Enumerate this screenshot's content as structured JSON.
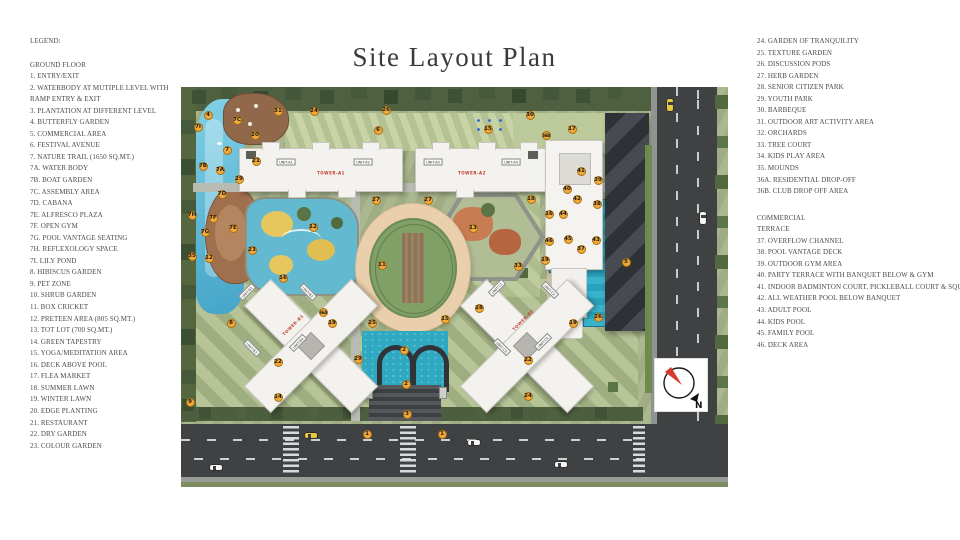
{
  "title": "Site Layout Plan",
  "legend_left": {
    "heading": "LEGEND:",
    "section": "GROUND FLOOR",
    "lines": [
      "1. ENTRY/EXIT",
      "2. WATERBODY AT MUTIPLE LEVEL WITH",
      "RAMP ENTRY & EXIT",
      "3. PLANTATION AT DIFFERENT LEVEL",
      "4. BUTTERFLY GARDEN",
      "5. COMMERCIAL AREA",
      "6. FESTIVAL AVENUE",
      "7. NATURE TRAIL (1650 SQ.MT.)",
      "7A. WATER BODY",
      "7B. BOAT GARDEN",
      "7C. ASSEMBLY AREA",
      "7D. CABANA",
      "7E. ALFRESCO PLAZA",
      "7F. OPEN GYM",
      "7G. POOL VANTAGE SEATING",
      "7H. REFLEXOLOGY SPACE",
      "7I. LILY POND",
      "8. HIBISCUS GARDEN",
      "9. PET ZONE",
      "10. SHRUB GARDEN",
      "11. BOX CRICKET",
      "12. PRETEEN AREA (805 SQ.MT.)",
      "13. TOT LOT (700 SQ.MT.)",
      "14. GREEN TAPESTRY",
      "15. YOGA/MEDITATION AREA",
      "16. DECK ABOVE POOL",
      "17. FLEA MARKET",
      "18. SUMMER LAWN",
      "19. WINTER LAWN",
      "20. EDGE PLANTING",
      "21. RESTAURANT",
      "22. DRY GARDEN",
      "23. COLOUR GARDEN"
    ]
  },
  "legend_right": {
    "lines_top": [
      "24. GARDEN OF TRANQUILITY",
      "25. TEXTURE GARDEN",
      "26. DISCUSSION PODS",
      "27. HERB GARDEN",
      "28. SENIOR CITIZEN PARK",
      "29. YOUTH PARK",
      "30. BARBEQUE",
      "31. OUTDOOR ART ACTIVITY AREA",
      "32. ORCHARDS",
      "33. TREE COURT",
      "34. KIDS PLAY AREA",
      "35. MOUNDS",
      "36A. RESIDENTIAL DROP-OFF",
      "36B. CLUB DROP OFF AREA"
    ],
    "section_lines": [
      "COMMERCIAL",
      "TERRACE"
    ],
    "lines_bottom": [
      "37. OVERFLOW CHANNEL",
      "38. POOL VANTAGE DECK",
      "39. OUTDOOR GYM AREA",
      "40. PARTY TERRACE WITH BANQUET BELOW & GYM",
      "41. INDOOR BADMINTON COURT, PICKLEBALL COURT & SQUASH COURT",
      "42. ALL WEATHER POOL BELOW BANQUET",
      "43. ADULT POOL",
      "44. KIDS POOL",
      "45. FAMILY POOL",
      "46. DECK AREA"
    ]
  },
  "plan": {
    "north_label": "N",
    "colors": {
      "lawn": "#a6b389",
      "marker": "#f2a93b",
      "water": "#46a5c8",
      "pool": "#2aa2bd",
      "road": "#3f4143",
      "north_red": "#d63a2f"
    },
    "markers": [
      {
        "n": "4",
        "x": 27,
        "y": 28
      },
      {
        "n": "7I",
        "x": 17,
        "y": 40
      },
      {
        "n": "7C",
        "x": 56,
        "y": 33
      },
      {
        "n": "20",
        "x": 74,
        "y": 48
      },
      {
        "n": "31",
        "x": 97,
        "y": 24
      },
      {
        "n": "24",
        "x": 133,
        "y": 24
      },
      {
        "n": "26",
        "x": 205,
        "y": 23
      },
      {
        "n": "30",
        "x": 349,
        "y": 28
      },
      {
        "n": "6",
        "x": 197,
        "y": 43
      },
      {
        "n": "15",
        "x": 307,
        "y": 42
      },
      {
        "n": "36B",
        "x": 365,
        "y": 48
      },
      {
        "n": "17",
        "x": 391,
        "y": 42
      },
      {
        "n": "7",
        "x": 46,
        "y": 63
      },
      {
        "n": "21",
        "x": 75,
        "y": 74
      },
      {
        "n": "7B",
        "x": 22,
        "y": 79
      },
      {
        "n": "7A",
        "x": 39,
        "y": 83
      },
      {
        "n": "29",
        "x": 58,
        "y": 92
      },
      {
        "n": "7D",
        "x": 41,
        "y": 107
      },
      {
        "n": "7H",
        "x": 11,
        "y": 128
      },
      {
        "n": "7F",
        "x": 32,
        "y": 131
      },
      {
        "n": "7E",
        "x": 52,
        "y": 141
      },
      {
        "n": "7G",
        "x": 24,
        "y": 145
      },
      {
        "n": "41",
        "x": 400,
        "y": 84
      },
      {
        "n": "39",
        "x": 417,
        "y": 93
      },
      {
        "n": "40",
        "x": 386,
        "y": 102
      },
      {
        "n": "42",
        "x": 396,
        "y": 112
      },
      {
        "n": "38",
        "x": 416,
        "y": 117
      },
      {
        "n": "18",
        "x": 350,
        "y": 112
      },
      {
        "n": "27",
        "x": 195,
        "y": 113
      },
      {
        "n": "27",
        "x": 247,
        "y": 113
      },
      {
        "n": "13",
        "x": 292,
        "y": 141
      },
      {
        "n": "12",
        "x": 132,
        "y": 140
      },
      {
        "n": "16",
        "x": 368,
        "y": 127
      },
      {
        "n": "44",
        "x": 382,
        "y": 127
      },
      {
        "n": "46",
        "x": 368,
        "y": 154
      },
      {
        "n": "45",
        "x": 387,
        "y": 152
      },
      {
        "n": "37",
        "x": 400,
        "y": 162
      },
      {
        "n": "43",
        "x": 415,
        "y": 153
      },
      {
        "n": "11",
        "x": 201,
        "y": 178
      },
      {
        "n": "25",
        "x": 191,
        "y": 236
      },
      {
        "n": "15",
        "x": 264,
        "y": 232
      },
      {
        "n": "23",
        "x": 71,
        "y": 163
      },
      {
        "n": "16",
        "x": 102,
        "y": 191
      },
      {
        "n": "33",
        "x": 337,
        "y": 179
      },
      {
        "n": "19",
        "x": 364,
        "y": 173
      },
      {
        "n": "5",
        "x": 445,
        "y": 175
      },
      {
        "n": "8",
        "x": 50,
        "y": 236
      },
      {
        "n": "36A",
        "x": 142,
        "y": 225
      },
      {
        "n": "19",
        "x": 151,
        "y": 236
      },
      {
        "n": "35",
        "x": 11,
        "y": 169
      },
      {
        "n": "12",
        "x": 28,
        "y": 171
      },
      {
        "n": "28",
        "x": 298,
        "y": 221
      },
      {
        "n": "26",
        "x": 417,
        "y": 230
      },
      {
        "n": "19",
        "x": 392,
        "y": 236
      },
      {
        "n": "29",
        "x": 177,
        "y": 272
      },
      {
        "n": "2",
        "x": 223,
        "y": 263
      },
      {
        "n": "2",
        "x": 225,
        "y": 297
      },
      {
        "n": "3",
        "x": 226,
        "y": 327
      },
      {
        "n": "22",
        "x": 97,
        "y": 275
      },
      {
        "n": "14",
        "x": 97,
        "y": 310
      },
      {
        "n": "9",
        "x": 9,
        "y": 315
      },
      {
        "n": "22",
        "x": 347,
        "y": 273
      },
      {
        "n": "24",
        "x": 347,
        "y": 309
      },
      {
        "n": "1",
        "x": 186,
        "y": 347
      },
      {
        "n": "1",
        "x": 261,
        "y": 347
      }
    ],
    "unit_labels": [
      {
        "t": "UNIT-A1",
        "x": 105,
        "y": 75,
        "r": 0
      },
      {
        "t": "UNIT-A2",
        "x": 182,
        "y": 75,
        "r": 0
      },
      {
        "t": "UNIT-A3",
        "x": 252,
        "y": 75,
        "r": 0
      },
      {
        "t": "UNIT-A4",
        "x": 330,
        "y": 75,
        "r": 0
      },
      {
        "t": "UNIT-B1",
        "x": 66,
        "y": 205,
        "r": -45
      },
      {
        "t": "UNIT-B2",
        "x": 127,
        "y": 205,
        "r": 45
      },
      {
        "t": "UNIT-B3",
        "x": 71,
        "y": 261,
        "r": 45
      },
      {
        "t": "UNIT-B4",
        "x": 117,
        "y": 256,
        "r": -45
      },
      {
        "t": "UNIT-C1",
        "x": 316,
        "y": 201,
        "r": -45
      },
      {
        "t": "UNIT-C2",
        "x": 369,
        "y": 203,
        "r": 45
      },
      {
        "t": "UNIT-C3",
        "x": 321,
        "y": 260,
        "r": 45
      },
      {
        "t": "UNIT-C4",
        "x": 362,
        "y": 255,
        "r": -45
      }
    ],
    "tower_labels": [
      {
        "t": "TOWER-A1",
        "x": 150,
        "y": 86,
        "r": 0
      },
      {
        "t": "TOWER-A2",
        "x": 291,
        "y": 86,
        "r": 0
      },
      {
        "t": "TOWER-B1",
        "x": 112,
        "y": 238,
        "r": -45
      },
      {
        "t": "TOWER-B2",
        "x": 342,
        "y": 233,
        "r": -45
      }
    ],
    "vehicles": [
      {
        "x": 124,
        "y": 346,
        "o": "h",
        "c": "#e8c93e"
      },
      {
        "x": 29,
        "y": 378,
        "o": "h",
        "c": "#f5f5f5"
      },
      {
        "x": 287,
        "y": 353,
        "o": "h",
        "c": "#f5f5f5"
      },
      {
        "x": 374,
        "y": 375,
        "o": "h",
        "c": "#f5f5f5"
      },
      {
        "x": 486,
        "y": 12,
        "o": "v",
        "c": "#e8c93e"
      },
      {
        "x": 519,
        "y": 125,
        "o": "v",
        "c": "#f5f5f5"
      }
    ]
  }
}
